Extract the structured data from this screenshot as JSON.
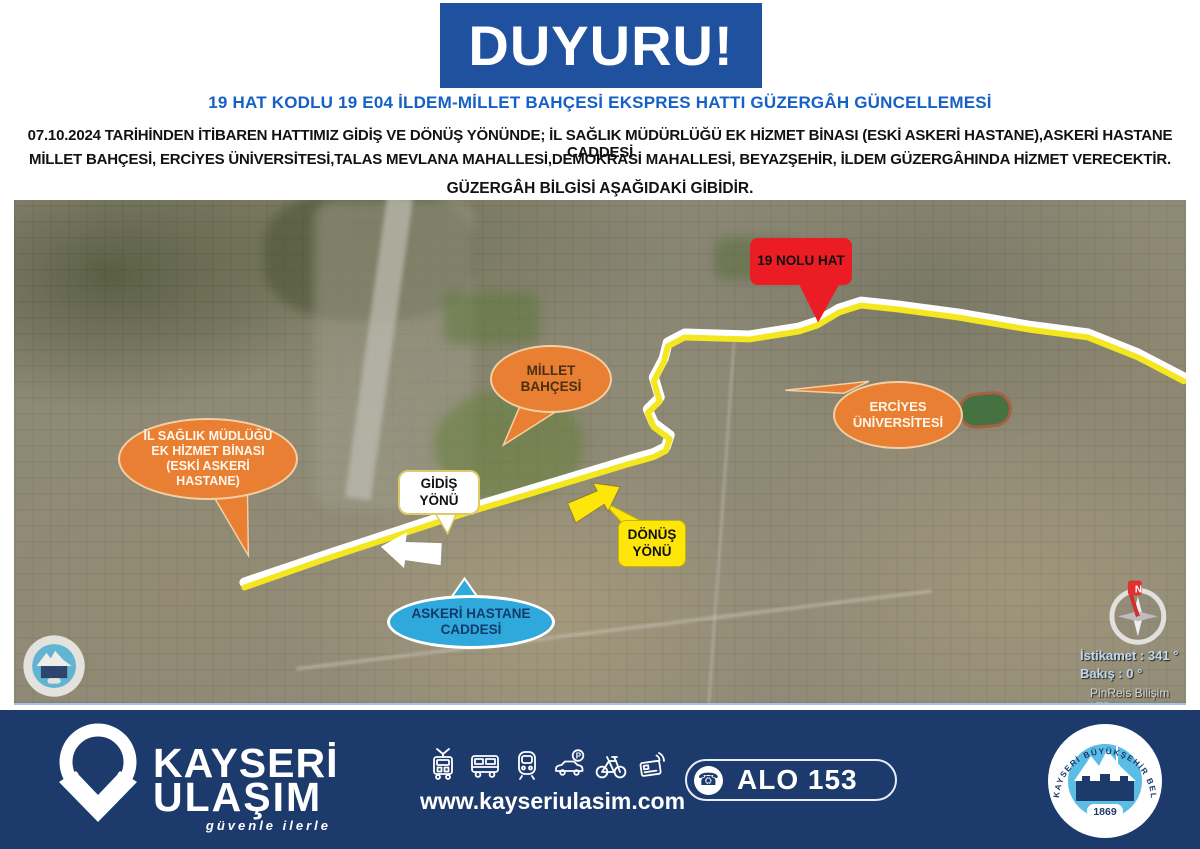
{
  "announcement": {
    "banner": "DUYURU!",
    "subtitle": "19 HAT KODLU 19 E04 İLDEM-MİLLET BAHÇESİ EKSPRES HATTI GÜZERGÂH GÜNCELLEMESİ",
    "body_line1": "07.10.2024 TARİHİNDEN İTİBAREN HATTIMIZ GİDİŞ VE DÖNÜŞ YÖNÜNDE; İL SAĞLIK MÜDÜRLÜĞÜ EK HİZMET BİNASI (ESKİ ASKERİ HASTANE),ASKERİ HASTANE CADDESİ",
    "body_line2": "MİLLET BAHÇESİ, ERCİYES ÜNİVERSİTESİ,TALAS MEVLANA MAHALLESİ,DEMOKRASİ MAHALLESİ, BEYAZŞEHİR, İLDEM GÜZERGÂHINDA HİZMET VERECEKTİR.",
    "body_line3": "GÜZERGÂH BİLGİSİ AŞAĞIDAKİ GİBİDİR."
  },
  "map": {
    "labels": {
      "route_badge": "19 NOLU HAT",
      "millet": "MİLLET BAHÇESİ",
      "erciyes": "ERCİYES ÜNİVERSİTESİ",
      "saglik": "İL SAĞLIK MÜDLÜĞÜ EK HİZMET BİNASI (ESKİ ASKERİ HASTANE)",
      "gidis": "GİDİŞ YÖNÜ",
      "donus": "DÖNÜŞ YÖNÜ",
      "askeri": "ASKERİ HASTANE CADDESİ"
    },
    "overlay": {
      "heading": "İstikamet : 341 °",
      "view": "Bakış : 0 °",
      "credit": "PinReis Bilişim LTD",
      "compass_north": "N"
    }
  },
  "footer": {
    "brand_line1": "KAYSERİ",
    "brand_line2": "ULAŞIM",
    "tagline": "güvenle ilerle",
    "website": "www.kayseriulasim.com",
    "hotline_icon": "phone-icon",
    "hotline": "ALO 153",
    "transport_icons": [
      "tram-icon",
      "bus-icon",
      "metro-icon",
      "car-parking-icon",
      "bicycle-icon",
      "contactless-card-icon"
    ],
    "seal_text": "KAYSERİ BÜYÜKŞEHİR BELEDİYESİ",
    "seal_year": "1869"
  },
  "colors": {
    "banner_blue": "#20519E",
    "subtitle_blue": "#1560C6",
    "footer_navy": "#1C3A6B",
    "callout_red": "#EC1C24",
    "callout_orange": "#E87F33",
    "callout_light_blue": "#2FA8DC",
    "callout_yellow": "#FFE60A",
    "route_yellow": "#F4E71F",
    "seal_light_blue": "#5BBCE4"
  }
}
